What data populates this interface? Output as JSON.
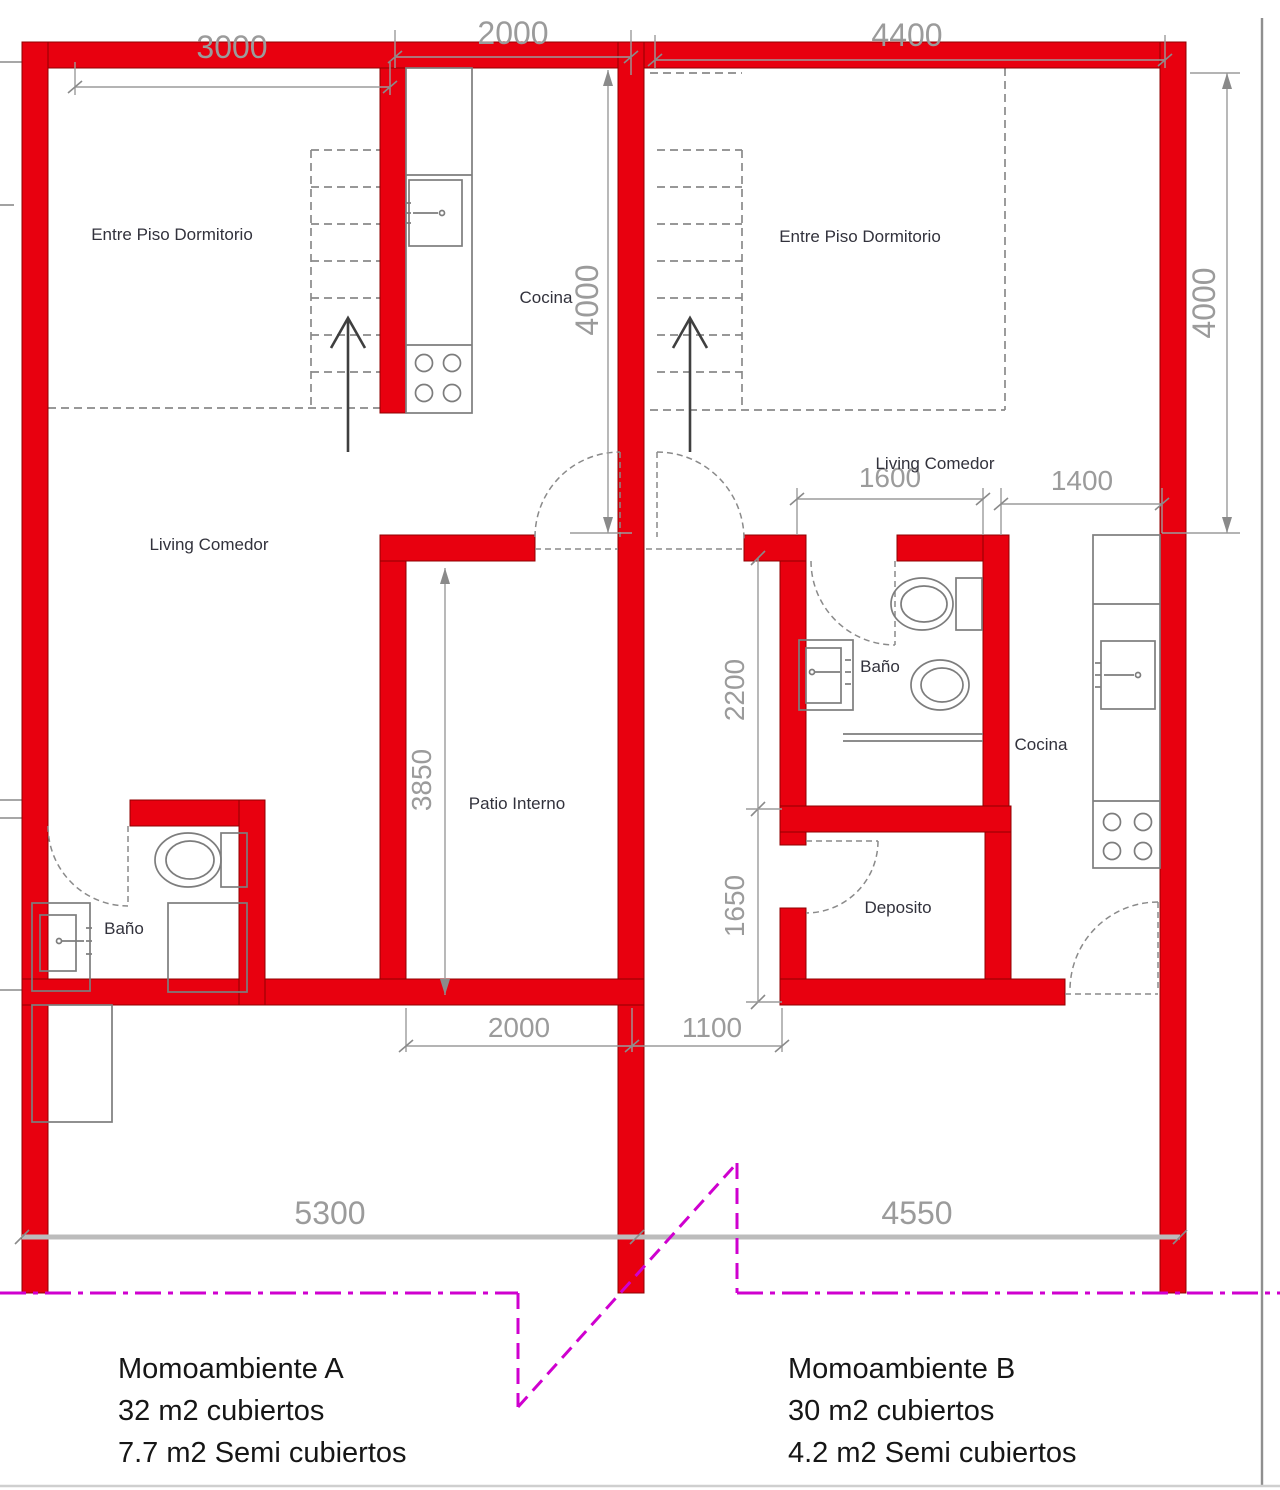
{
  "drawing": {
    "units": [
      {
        "id": "A",
        "name": "Momoambiente A",
        "area_covered": "32 m2 cubiertos",
        "area_semi": "7.7 m2 Semi cubiertos"
      },
      {
        "id": "B",
        "name": "Momoambiente B",
        "area_covered": "30 m2 cubiertos",
        "area_semi": "4.2 m2 Semi cubiertos"
      }
    ],
    "rooms": {
      "a_mezzanine": "Entre Piso Dormitorio",
      "a_kitchen": "Cocina",
      "a_living": "Living Comedor",
      "a_bath": "Baño",
      "patio": "Patio Interno",
      "b_mezzanine": "Entre Piso Dormitorio",
      "b_living": "Living Comedor",
      "b_bath": "Baño",
      "b_kitchen": "Cocina",
      "b_storage": "Deposito"
    },
    "dimensions": {
      "a_living_width": "3000",
      "a_kitchen_width": "2000",
      "b_width": "4400",
      "a_mezzanine_depth": "4000",
      "b_mezzanine_depth": "4000",
      "b_bath_width": "1600",
      "b_kitchen_width": "1400",
      "b_bath_depth": "2200",
      "b_storage_depth": "1650",
      "patio_depth": "3850",
      "patio_width": "2000",
      "b_passage_width": "1100",
      "a_total_width": "5300",
      "b_total_width": "4550"
    },
    "colors": {
      "wall": "#e8000f",
      "wall_edge": "#8f0000",
      "dimension": "#9b9b9b",
      "room_label": "#32323c",
      "property_line": "#cf00cf",
      "footer_text": "#161616"
    }
  }
}
